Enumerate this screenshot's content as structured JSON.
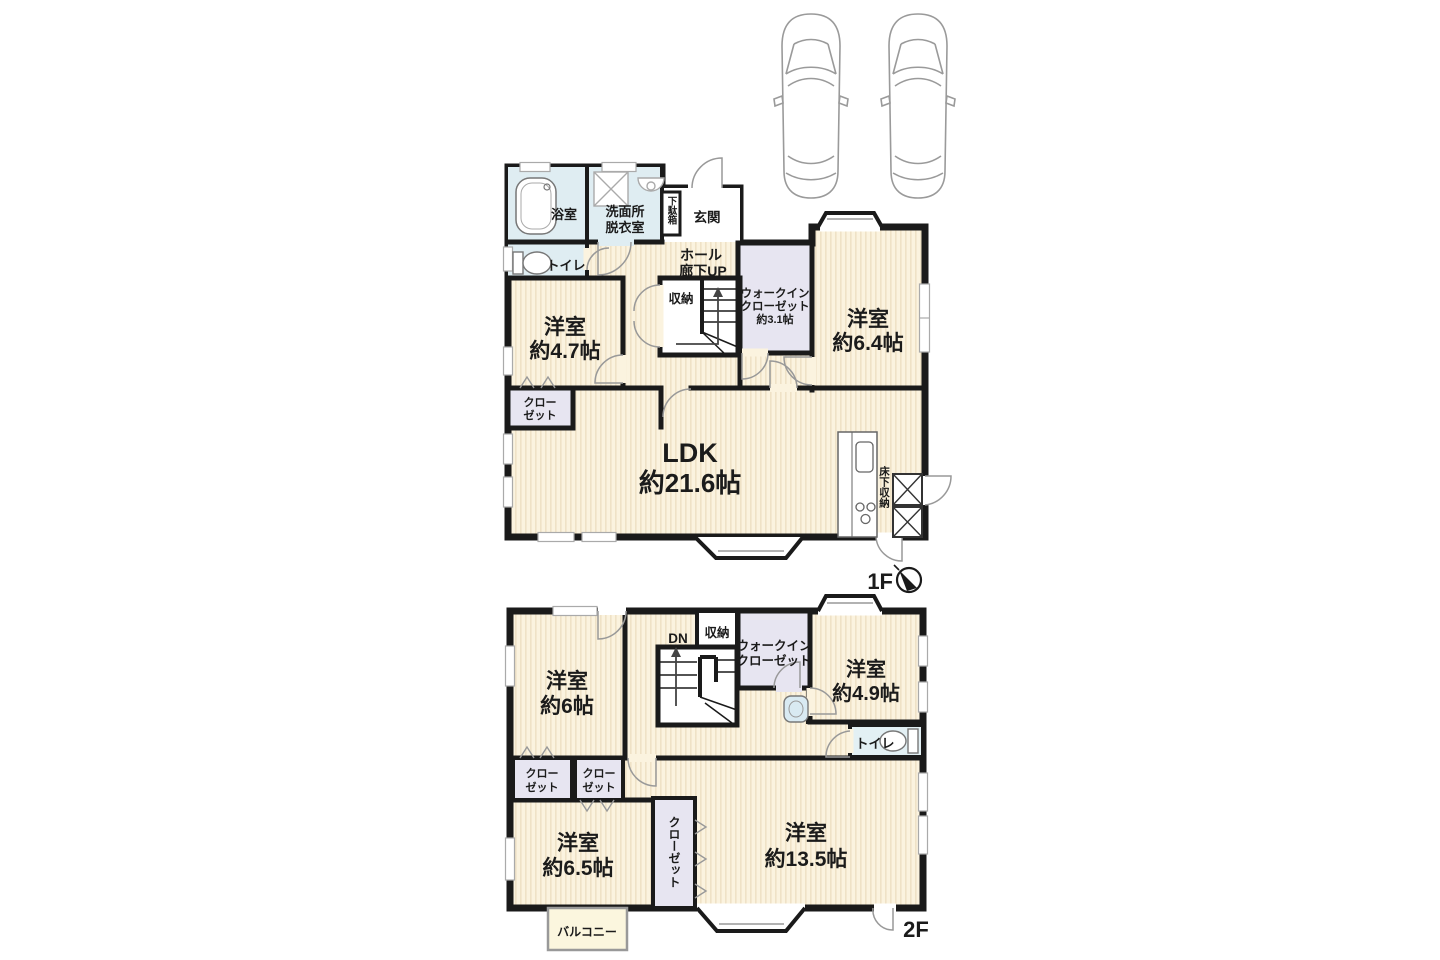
{
  "colors": {
    "wall": "#1a1a1a",
    "room_cream": "#FBF3DF",
    "room_stripe": "#EFE2C6",
    "closet_lavender": "#E7E5F1",
    "wet_area_blue": "#DFEDF2",
    "fixture_gray": "#999999",
    "balcony_fill": "#FBF6DE"
  },
  "f1": {
    "floor_label": "1F",
    "bath": "浴室",
    "washroom_line1": "洗面所",
    "washroom_line2": "脱衣室",
    "shoebox": "下駄箱",
    "entrance": "玄関",
    "toilet": "トイレ",
    "hall_line1": "ホール",
    "hall_line2": "廊下UP",
    "storage": "収納",
    "wic_line1": "ウォークイン",
    "wic_line2": "クローゼット",
    "wic_line3": "約3.1帖",
    "room64_line1": "洋室",
    "room64_line2": "約6.4帖",
    "room47_line1": "洋室",
    "room47_line2": "約4.7帖",
    "closet_line1": "クロー",
    "closet_line2": "ゼット",
    "ldk_line1": "LDK",
    "ldk_line2": "約21.6帖",
    "floor_storage": "床下収納"
  },
  "f2": {
    "floor_label": "2F",
    "dn": "DN",
    "storage": "収納",
    "wic_line1": "ウォークイン",
    "wic_line2": "クローゼット",
    "room6_line1": "洋室",
    "room6_line2": "約6帖",
    "room49_line1": "洋室",
    "room49_line2": "約4.9帖",
    "toilet": "トイレ",
    "closet_a_line1": "クロー",
    "closet_a_line2": "ゼット",
    "closet_b_line1": "クロー",
    "closet_b_line2": "ゼット",
    "room65_line1": "洋室",
    "room65_line2": "約6.5帖",
    "closet_tall": "クローゼット",
    "room135_line1": "洋室",
    "room135_line2": "約13.5帖",
    "balcony": "バルコニー"
  }
}
